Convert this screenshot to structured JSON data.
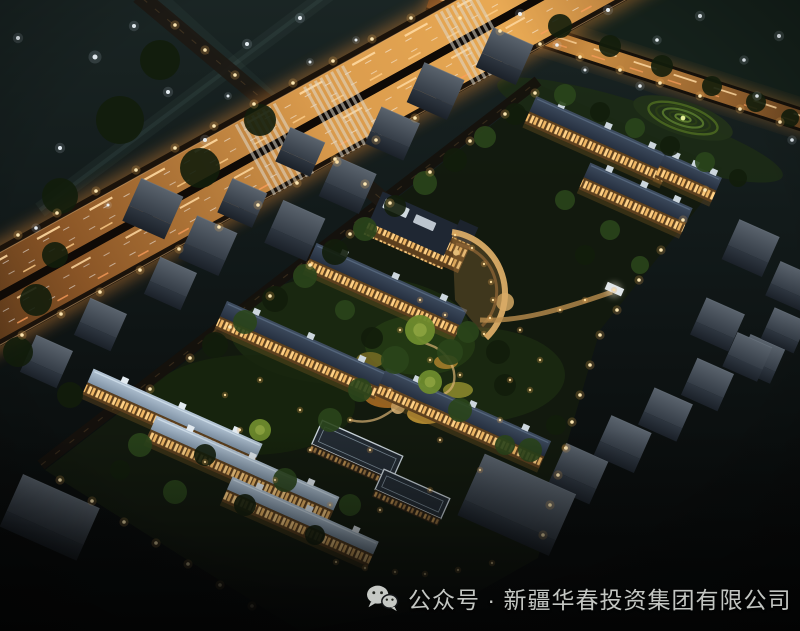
{
  "image": {
    "kind": "aerial-night-rendering",
    "subject": "residential compound bird's-eye view at night",
    "width": 800,
    "height": 631
  },
  "caption": {
    "icon": "wechat-icon",
    "text": "公众号 · 新疆华春投资集团有限公司"
  },
  "palette": {
    "captionFg": "#c3c6c2",
    "skyTop": "#1a2524",
    "skyBottom": "#060808",
    "roadGlow": "#e8a954",
    "roadTrail": "#ffd9a0",
    "facadeGold": "#d3a158",
    "windowWarm": "#ffd084",
    "roofSlate": "#3f4d60",
    "roofPale": "#b3c4d4",
    "contextGray": "#5a636d",
    "treeDark": "#121d0b",
    "treeLit": "#6e8b2d",
    "lampWarm": "#ffe9b4",
    "lampCool": "#eef6fb"
  },
  "scene": {
    "sky_lights": [
      [
        18,
        38,
        2
      ],
      [
        95,
        57,
        2.5
      ],
      [
        134,
        26,
        2
      ],
      [
        168,
        92,
        2
      ],
      [
        205,
        140,
        2
      ],
      [
        60,
        148,
        2
      ],
      [
        36,
        228,
        1.8
      ],
      [
        108,
        205,
        1.5
      ],
      [
        247,
        44,
        2
      ],
      [
        300,
        18,
        2
      ],
      [
        228,
        96,
        1.5
      ],
      [
        310,
        62,
        1.5
      ],
      [
        356,
        40,
        1.5
      ],
      [
        520,
        14,
        2
      ],
      [
        557,
        45,
        1.8
      ],
      [
        608,
        10,
        2
      ],
      [
        657,
        40,
        1.8
      ],
      [
        700,
        16,
        2
      ],
      [
        744,
        60,
        1.8
      ],
      [
        779,
        36,
        2
      ],
      [
        640,
        86,
        1.8
      ],
      [
        585,
        70,
        1.5
      ],
      [
        757,
        96,
        1.8
      ],
      [
        792,
        140,
        1.8
      ]
    ],
    "street_lights": [
      [
        22,
        335
      ],
      [
        61,
        314
      ],
      [
        100,
        292
      ],
      [
        140,
        270
      ],
      [
        179,
        249
      ],
      [
        219,
        227
      ],
      [
        258,
        205
      ],
      [
        297,
        183
      ],
      [
        337,
        162
      ],
      [
        376,
        140
      ],
      [
        415,
        118
      ],
      [
        18,
        235
      ],
      [
        57,
        213
      ],
      [
        96,
        191
      ],
      [
        136,
        170
      ],
      [
        175,
        148
      ],
      [
        214,
        126
      ],
      [
        254,
        104
      ],
      [
        293,
        83
      ],
      [
        333,
        61
      ],
      [
        372,
        39
      ],
      [
        411,
        18
      ],
      [
        460,
        18
      ],
      [
        500,
        31
      ],
      [
        540,
        44
      ],
      [
        580,
        57
      ],
      [
        620,
        70
      ],
      [
        660,
        83
      ],
      [
        700,
        96
      ],
      [
        740,
        109
      ],
      [
        780,
        122
      ],
      [
        150,
        389
      ],
      [
        190,
        358
      ],
      [
        230,
        327
      ],
      [
        270,
        296
      ],
      [
        310,
        265
      ],
      [
        350,
        234
      ],
      [
        390,
        203
      ],
      [
        430,
        172
      ],
      [
        470,
        141
      ],
      [
        505,
        114
      ],
      [
        535,
        93
      ],
      [
        705,
        190
      ],
      [
        683,
        220
      ],
      [
        661,
        250
      ],
      [
        639,
        280
      ],
      [
        617,
        310
      ],
      [
        600,
        335
      ],
      [
        590,
        365
      ],
      [
        580,
        395
      ],
      [
        572,
        422
      ],
      [
        566,
        448
      ],
      [
        558,
        475
      ],
      [
        550,
        505
      ],
      [
        543,
        535
      ],
      [
        60,
        480
      ],
      [
        92,
        501
      ],
      [
        124,
        522
      ],
      [
        156,
        543
      ],
      [
        188,
        564
      ],
      [
        220,
        585
      ],
      [
        252,
        606
      ],
      [
        175,
        25
      ],
      [
        205,
        50
      ],
      [
        235,
        75
      ],
      [
        335,
        159
      ],
      [
        365,
        184
      ]
    ],
    "path_lights": [
      [
        455,
        235
      ],
      [
        472,
        248
      ],
      [
        484,
        264
      ],
      [
        491,
        282
      ],
      [
        493,
        300
      ],
      [
        490,
        318
      ],
      [
        484,
        334
      ],
      [
        420,
        300
      ],
      [
        445,
        315
      ],
      [
        400,
        330
      ],
      [
        430,
        360
      ],
      [
        460,
        375
      ],
      [
        390,
        390
      ],
      [
        350,
        420
      ],
      [
        310,
        450
      ],
      [
        370,
        450
      ],
      [
        440,
        440
      ],
      [
        500,
        420
      ],
      [
        530,
        390
      ],
      [
        480,
        470
      ],
      [
        430,
        490
      ],
      [
        380,
        510
      ],
      [
        520,
        330
      ],
      [
        560,
        310
      ],
      [
        585,
        300
      ],
      [
        240,
        430
      ],
      [
        205,
        462
      ],
      [
        275,
        480
      ],
      [
        330,
        505
      ],
      [
        300,
        410
      ],
      [
        260,
        380
      ],
      [
        225,
        395
      ],
      [
        540,
        360
      ],
      [
        510,
        380
      ],
      [
        565,
        448
      ],
      [
        614,
        290
      ],
      [
        336,
        562
      ],
      [
        365,
        568
      ],
      [
        395,
        572
      ],
      [
        425,
        574
      ],
      [
        458,
        570
      ],
      [
        492,
        563
      ]
    ],
    "trees": [
      [
        215,
        345,
        13,
        0
      ],
      [
        245,
        322,
        12,
        1
      ],
      [
        275,
        299,
        13,
        0
      ],
      [
        305,
        276,
        12,
        1
      ],
      [
        335,
        252,
        13,
        0
      ],
      [
        365,
        229,
        12,
        1
      ],
      [
        395,
        206,
        11,
        0
      ],
      [
        425,
        183,
        12,
        1
      ],
      [
        455,
        160,
        12,
        0
      ],
      [
        485,
        137,
        11,
        1
      ],
      [
        515,
        114,
        11,
        0
      ],
      [
        565,
        95,
        11,
        1
      ],
      [
        600,
        112,
        10,
        0
      ],
      [
        635,
        128,
        10,
        1
      ],
      [
        670,
        146,
        10,
        0
      ],
      [
        705,
        162,
        10,
        1
      ],
      [
        738,
        178,
        9,
        0
      ],
      [
        420,
        330,
        15,
        2
      ],
      [
        450,
        352,
        13,
        1
      ],
      [
        395,
        360,
        14,
        1
      ],
      [
        430,
        382,
        12,
        2
      ],
      [
        468,
        332,
        11,
        1
      ],
      [
        498,
        352,
        12,
        0
      ],
      [
        372,
        338,
        11,
        0
      ],
      [
        360,
        390,
        12,
        1
      ],
      [
        460,
        410,
        12,
        1
      ],
      [
        505,
        385,
        11,
        0
      ],
      [
        345,
        310,
        10,
        1
      ],
      [
        330,
        420,
        12,
        1
      ],
      [
        260,
        430,
        11,
        2
      ],
      [
        530,
        450,
        12,
        1
      ],
      [
        556,
        425,
        10,
        0
      ],
      [
        505,
        445,
        10,
        1
      ],
      [
        140,
        445,
        12,
        1
      ],
      [
        205,
        455,
        11,
        0
      ],
      [
        175,
        492,
        12,
        1
      ],
      [
        245,
        505,
        11,
        0
      ],
      [
        285,
        480,
        12,
        1
      ],
      [
        315,
        535,
        10,
        0
      ],
      [
        350,
        505,
        11,
        1
      ],
      [
        120,
        470,
        10,
        0
      ],
      [
        610,
        230,
        10,
        1
      ],
      [
        585,
        255,
        10,
        0
      ],
      [
        640,
        265,
        9,
        1
      ],
      [
        565,
        200,
        10,
        1
      ],
      [
        36,
        300,
        16,
        0
      ],
      [
        18,
        352,
        15,
        0
      ],
      [
        55,
        255,
        13,
        0
      ],
      [
        70,
        395,
        13,
        0
      ],
      [
        560,
        26,
        12,
        0
      ],
      [
        610,
        46,
        11,
        0
      ],
      [
        662,
        66,
        11,
        0
      ],
      [
        712,
        86,
        10,
        0
      ],
      [
        756,
        102,
        10,
        0
      ],
      [
        790,
        118,
        9,
        0
      ],
      [
        120,
        120,
        24,
        0
      ],
      [
        200,
        168,
        20,
        0
      ],
      [
        60,
        196,
        18,
        0
      ],
      [
        160,
        60,
        20,
        0
      ],
      [
        260,
        120,
        16,
        0
      ]
    ],
    "context_buildings": [
      [
        150,
        215,
        46,
        30
      ],
      [
        205,
        252,
        44,
        30
      ],
      [
        168,
        289,
        40,
        26
      ],
      [
        240,
        208,
        38,
        24
      ],
      [
        292,
        237,
        46,
        30
      ],
      [
        345,
        191,
        44,
        28
      ],
      [
        298,
        157,
        38,
        24
      ],
      [
        390,
        139,
        42,
        26
      ],
      [
        433,
        97,
        44,
        28
      ],
      [
        502,
        62,
        44,
        28
      ],
      [
        98,
        330,
        40,
        26
      ],
      [
        44,
        367,
        40,
        26
      ],
      [
        45,
        528,
        84,
        40
      ],
      [
        748,
        254,
        44,
        28
      ],
      [
        788,
        291,
        38,
        24
      ],
      [
        715,
        330,
        42,
        26
      ],
      [
        758,
        364,
        38,
        24
      ],
      [
        575,
        480,
        46,
        30
      ],
      [
        620,
        450,
        44,
        28
      ],
      [
        663,
        420,
        42,
        26
      ],
      [
        705,
        390,
        40,
        26
      ],
      [
        745,
        362,
        38,
        24
      ],
      [
        782,
        335,
        36,
        22
      ],
      [
        510,
        520,
        100,
        50
      ]
    ],
    "residential_rows": [
      [
        598,
        142,
        150,
        17,
        "slate"
      ],
      [
        635,
        200,
        112,
        16,
        "slate"
      ],
      [
        688,
        178,
        62,
        14,
        "slate"
      ],
      [
        385,
        292,
        165,
        17,
        "slate"
      ],
      [
        300,
        352,
        175,
        17,
        "slate"
      ],
      [
        462,
        420,
        180,
        17,
        "slate"
      ],
      [
        172,
        420,
        185,
        15,
        "pale"
      ],
      [
        242,
        470,
        200,
        15,
        "pale"
      ],
      [
        300,
        522,
        160,
        14,
        "pale"
      ],
      [
        352,
        462,
        88,
        26,
        "flat"
      ],
      [
        408,
        504,
        72,
        22,
        "flat"
      ]
    ]
  }
}
